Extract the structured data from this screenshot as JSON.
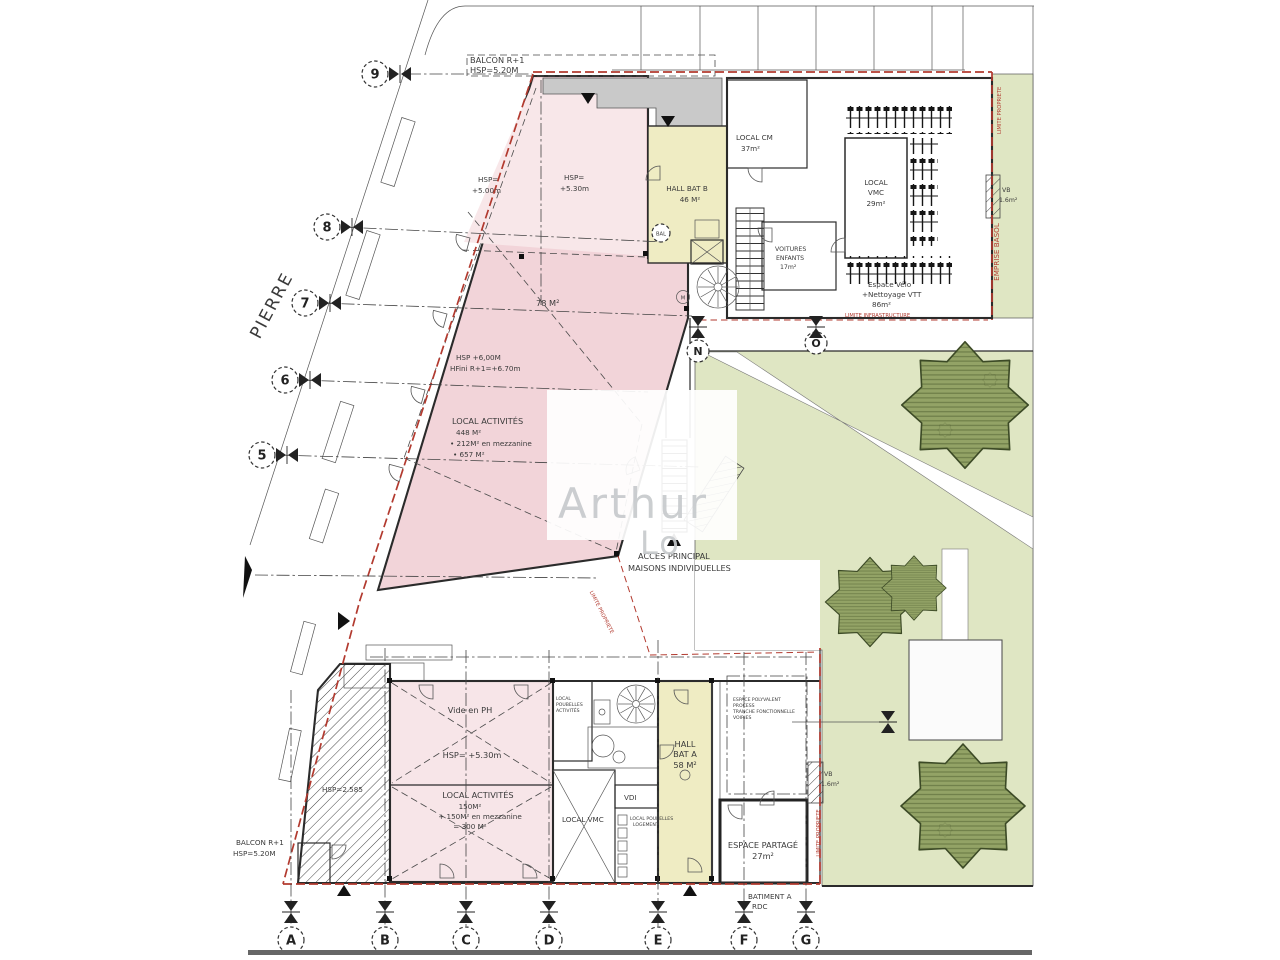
{
  "street": {
    "name": "PIERRE"
  },
  "grid": {
    "rows": [
      "9",
      "8",
      "7",
      "6",
      "5"
    ],
    "cols": [
      "A",
      "B",
      "C",
      "D",
      "E",
      "F",
      "G"
    ],
    "aux": [
      "N",
      "O"
    ]
  },
  "ann": {
    "balcon_top": {
      "l1": "BALCON R+1",
      "l2": "HSP=5.20M"
    },
    "balcon_bottom": {
      "l1": "BALCON R+1",
      "l2": "HSP=5.20M"
    },
    "acces": {
      "l1": "ACCES PRINCIPAL",
      "l2": "MAISONS INDIVIDUELLES"
    },
    "limite_propriete": "LIMITE PROPRIETE",
    "limite_infrastructure": "LIMITE INFRASTRUCTURE",
    "emprise_basol": "EMPRISE BASOL",
    "batiment_a": {
      "l1": "BATIMENT A",
      "l2": "RDC"
    }
  },
  "bat_b": {
    "hsp_a": {
      "l1": "HSP=",
      "l2": "+5.00m"
    },
    "hsp_b": {
      "l1": "HSP=",
      "l2": "+5.30m"
    },
    "surface_78": "78 M²",
    "hsp_c": {
      "l1": "HSP +6,00M",
      "l2": "HFini R+1=+6.70m"
    },
    "local_activites": {
      "name": "LOCAL ACTIVITÉS",
      "s1": "448 M²",
      "s2": "• 212M² en mezzanine",
      "s3": "• 657 M²"
    },
    "hall": {
      "l1": "HALL BAT B",
      "l2": "46 M²"
    },
    "bal": "BAL",
    "m_mark": "M",
    "local_cm": {
      "l1": "LOCAL CM",
      "l2": "37m²"
    },
    "local_vmc": {
      "l1": "LOCAL",
      "l2": "VMC",
      "l3": "29m²"
    },
    "voitures": {
      "l1": "VOITURES",
      "l2": "ENFANTS",
      "l3": "17m²"
    },
    "velo": {
      "l1": "Espace Vélo",
      "l2": "+Nettoyage VTT",
      "l3": "86m²"
    },
    "vb": {
      "l1": "VB",
      "l2": "1.6m²"
    }
  },
  "bat_a": {
    "vide": "Vide en PH",
    "hsp": "HSP= +5.30m",
    "hsp_hatch": "HSP=2.585",
    "local_activites": {
      "name": "LOCAL ACTIVITÉS",
      "s1": "150M²",
      "s2": "+ 150M² en mezzanine",
      "s3": "= 300 M²"
    },
    "local_vmc": "LOCAL VMC",
    "vdi": "VDI",
    "poubelles_act": {
      "l1": "LOCAL",
      "l2": "POUBELLES",
      "l3": "ACTIVITÉS"
    },
    "poubelles_log": {
      "l1": "LOCAL POUBELLES",
      "l2": "LOGEMENT"
    },
    "hall": {
      "l1": "HALL",
      "l2": "BAT A",
      "l3": "58 M²"
    },
    "espace_partage": {
      "l1": "ESPACE PARTAGÉ",
      "l2": "27m²"
    },
    "espace_poly": {
      "l1": "ESPACE POLYVALENT",
      "l2": "PROCESS",
      "l3": "TRANCHE FONCTIONNELLE",
      "l4": "VOIRIES"
    },
    "vb": {
      "l1": "VB",
      "l2": "1.6m²"
    }
  },
  "watermark": {
    "l1": "Arthur",
    "l2": "Lo"
  },
  "colors": {
    "red": "#b23a2f",
    "pink": "#f2d4d9",
    "pink_light": "#f8e7e9",
    "pink_pale": "#f7e5e8",
    "yellow": "#efecc3",
    "green": "#dfe6c3",
    "green_room": "#e3ead1",
    "tree": "#93a366",
    "gray": "#c6c6c6"
  }
}
